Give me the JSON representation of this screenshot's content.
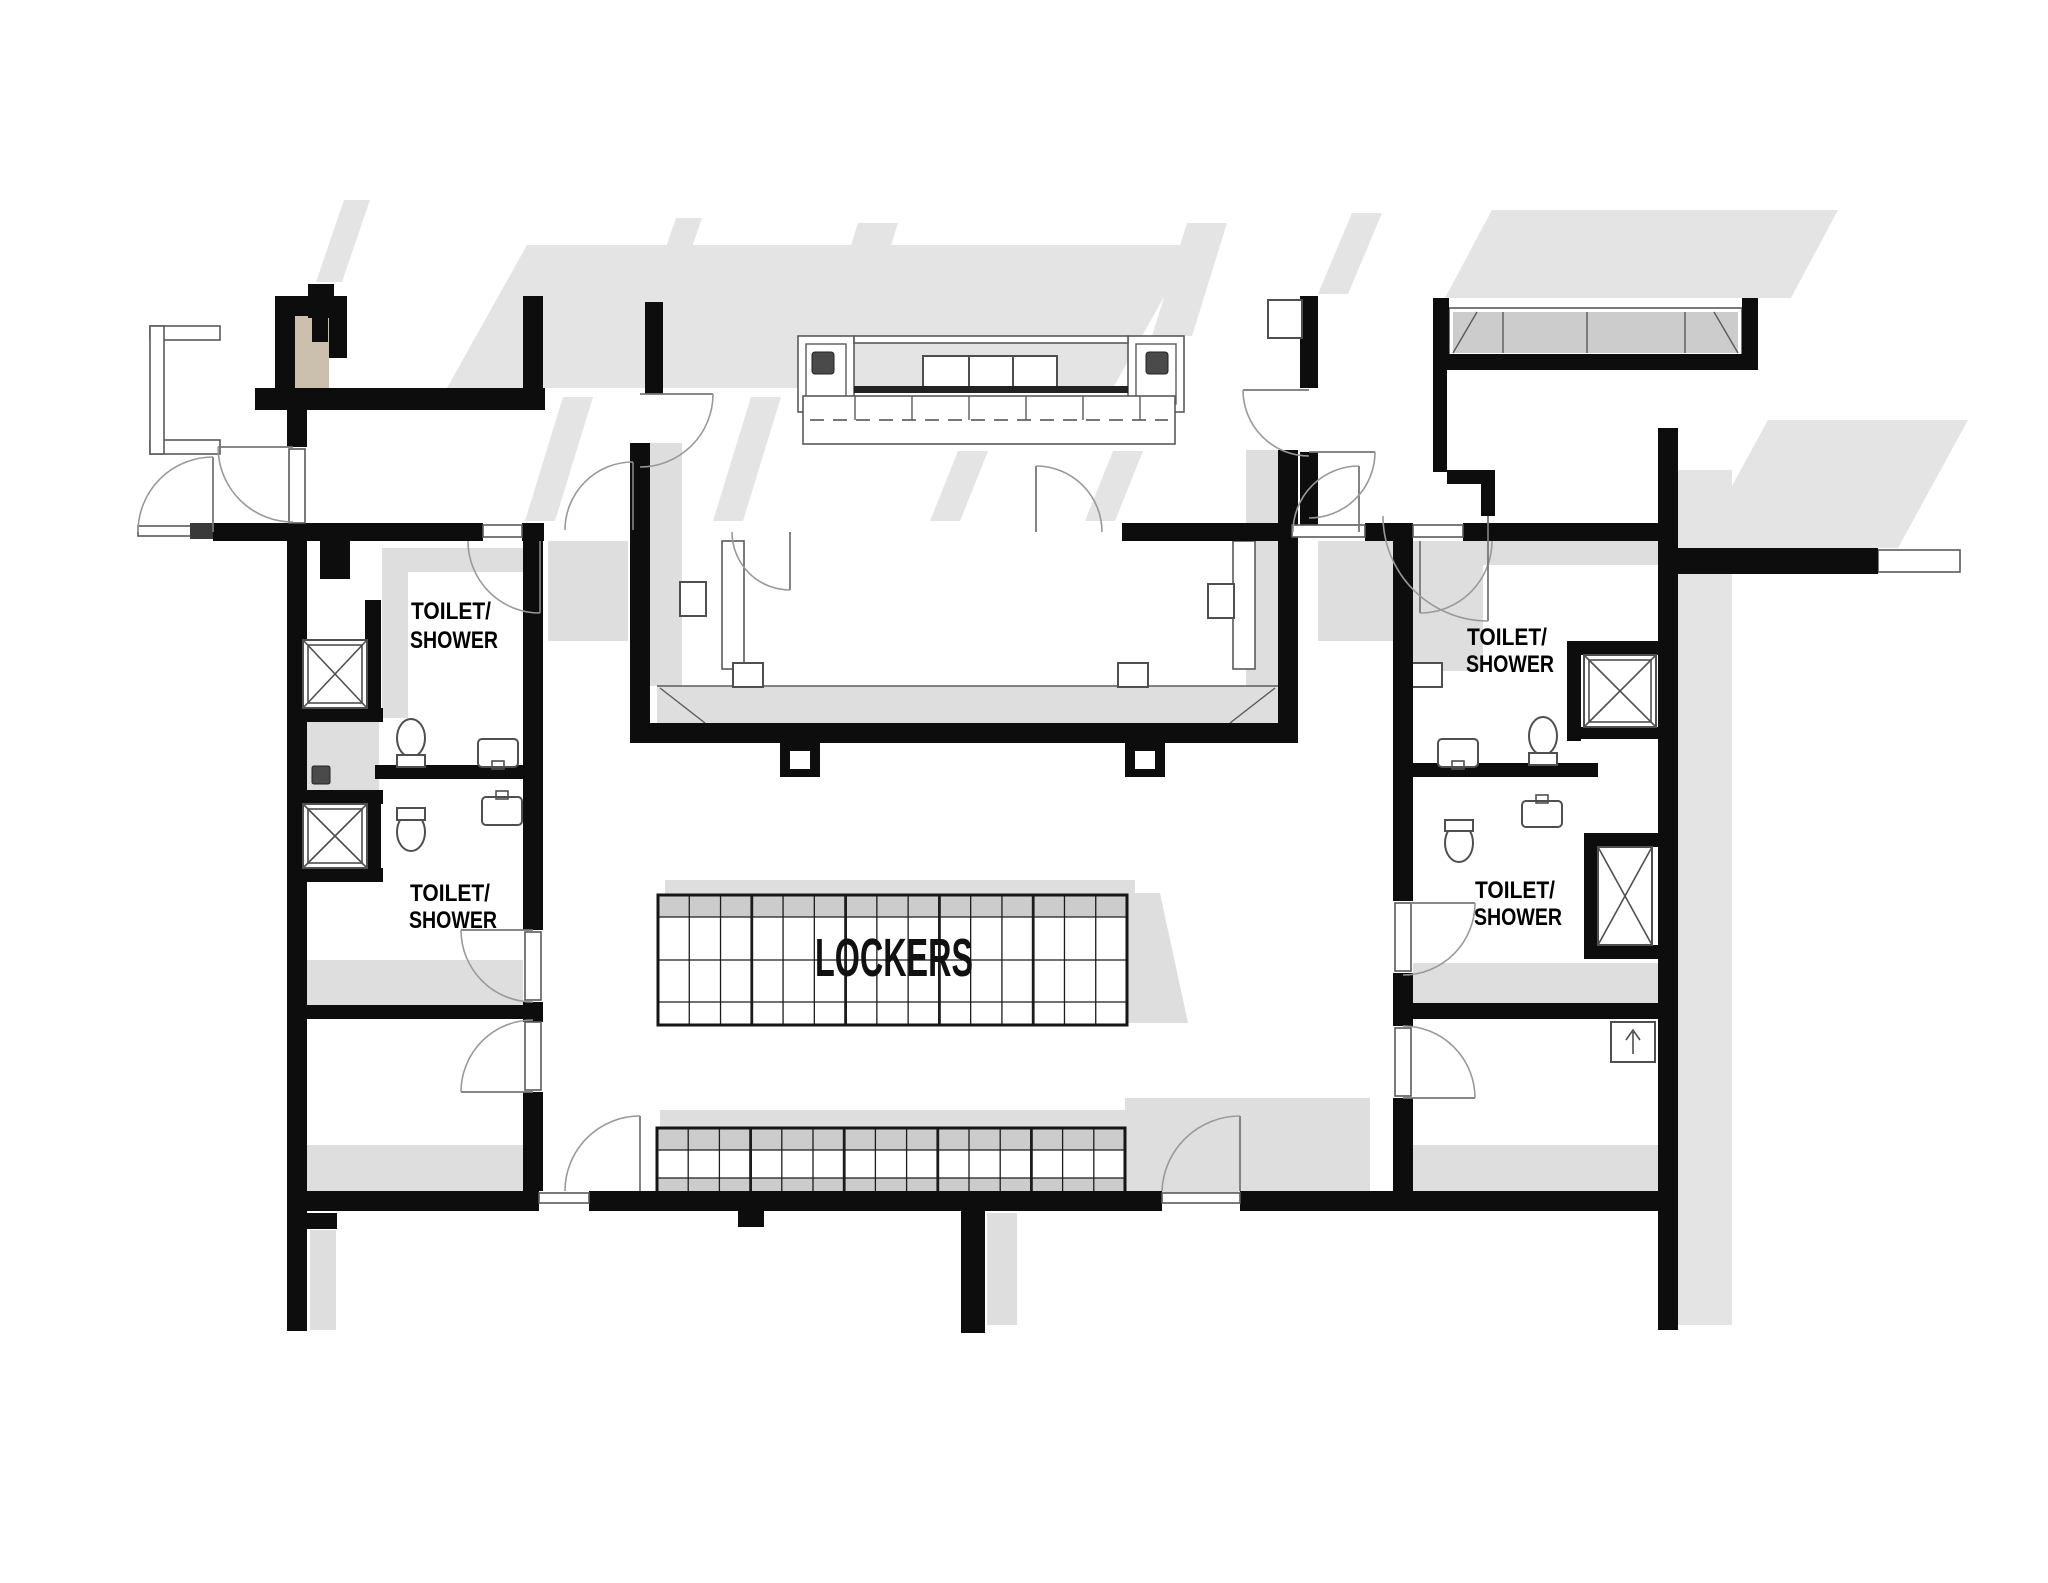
{
  "drawing": {
    "kind": "architectural floor plan",
    "area": "locker room with toilet/shower rooms"
  },
  "labels": {
    "lockers": "LOCKERS"
  },
  "rooms": [
    {
      "id": "toilet-shower-upper-left",
      "label_line1": "TOILET/",
      "label_line2": "SHOWER"
    },
    {
      "id": "toilet-shower-lower-left",
      "label_line1": "TOILET/",
      "label_line2": "SHOWER"
    },
    {
      "id": "toilet-shower-upper-right",
      "label_line1": "TOILET/",
      "label_line2": "SHOWER"
    },
    {
      "id": "toilet-shower-lower-right",
      "label_line1": "TOILET/",
      "label_line2": "SHOWER"
    }
  ],
  "lockers": {
    "label": "LOCKERS",
    "top_bank": {
      "columns": 15,
      "rows": 4,
      "shaded_rows": [
        0
      ],
      "group_every": 3
    },
    "bottom_bank": {
      "columns": 15,
      "rows": 3,
      "shaded_rows": [
        0,
        2
      ],
      "group_every": 3
    }
  },
  "colors": {
    "wall": "#0d0d0d",
    "shadow": "#e4e4e4",
    "floor_band": "#dedede",
    "locker_shade": "#cccccc",
    "fixture_stroke": "#4f4f4f",
    "arc_stroke": "#999999",
    "outline": "#5a5a5a",
    "tan_room_fill": "#cbc0ae",
    "dark_square": "#4a4a4a",
    "text": "#000000"
  }
}
